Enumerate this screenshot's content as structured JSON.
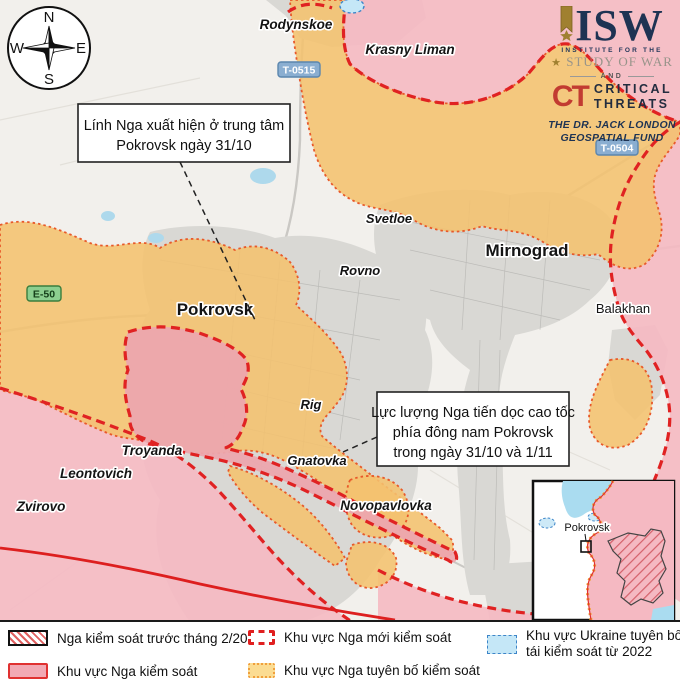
{
  "compass": {
    "north": "N",
    "east": "E",
    "south": "S",
    "west": "W"
  },
  "logos": {
    "isw_acronym": "ISW",
    "isw_sub1": "INSTITUTE FOR THE",
    "isw_star": "★",
    "isw_sub2": "STUDY OF WAR",
    "conjunction": "AND",
    "ct_monogram": "CT",
    "ct_word1": "CRITICAL",
    "ct_word2": "THREATS",
    "fund_line1": "THE DR. JACK LONDON",
    "fund_line2": "GEOSPATIAL FUND"
  },
  "annotations": {
    "box1": {
      "line1": "Lính Nga xuất hiện ở trung tâm",
      "line2": "Pokrovsk ngày 31/10"
    },
    "box2": {
      "line1": "Lực lượng Nga tiến dọc cao tốc",
      "line2": "phía đông nam Pokrovsk",
      "line3": "trong ngày 31/10 và 1/11"
    }
  },
  "road_shields": {
    "e50": "E-50",
    "t0515": "T-0515",
    "t0504": "T-0504"
  },
  "places": {
    "rodynskoe": "Rodynskoe",
    "krasny_liman": "Krasny Liman",
    "svetloe": "Svetloe",
    "rovno": "Rovno",
    "pokrovsk": "Pokrovsk",
    "mirnograd": "Mirnograd",
    "balakhan": "Balakhan",
    "rig": "Rig",
    "gnatovka": "Gnatovka",
    "troyanda": "Troyanda",
    "leontovich": "Leontovich",
    "zvirovo": "Zvirovo",
    "novopavlovka": "Novopavlovka"
  },
  "inset": {
    "label": "Pokrovsk"
  },
  "legend": {
    "pre2022": "Nga kiểm soát trước tháng 2/2022",
    "controlled": "Khu vực Nga kiểm soát",
    "new_control": "Khu vực Nga mới kiểm soát",
    "claimed": "Khu vực Nga tuyên bố kiểm soát",
    "ukraine_line1": "Khu vực Ukraine tuyên bố",
    "ukraine_line2": "tái kiểm soát từ 2022"
  },
  "colors": {
    "claimed_orange": "#f4c26e",
    "claimed_border": "#e8592a",
    "controlled_pink": "#f5b9c2",
    "new_control_pink": "#eca7ae",
    "front_red": "#e02222",
    "ukraine_blue": "#c5e7f7",
    "water_blue": "#aed9ec",
    "urban_gray": "#d9d8d4"
  }
}
